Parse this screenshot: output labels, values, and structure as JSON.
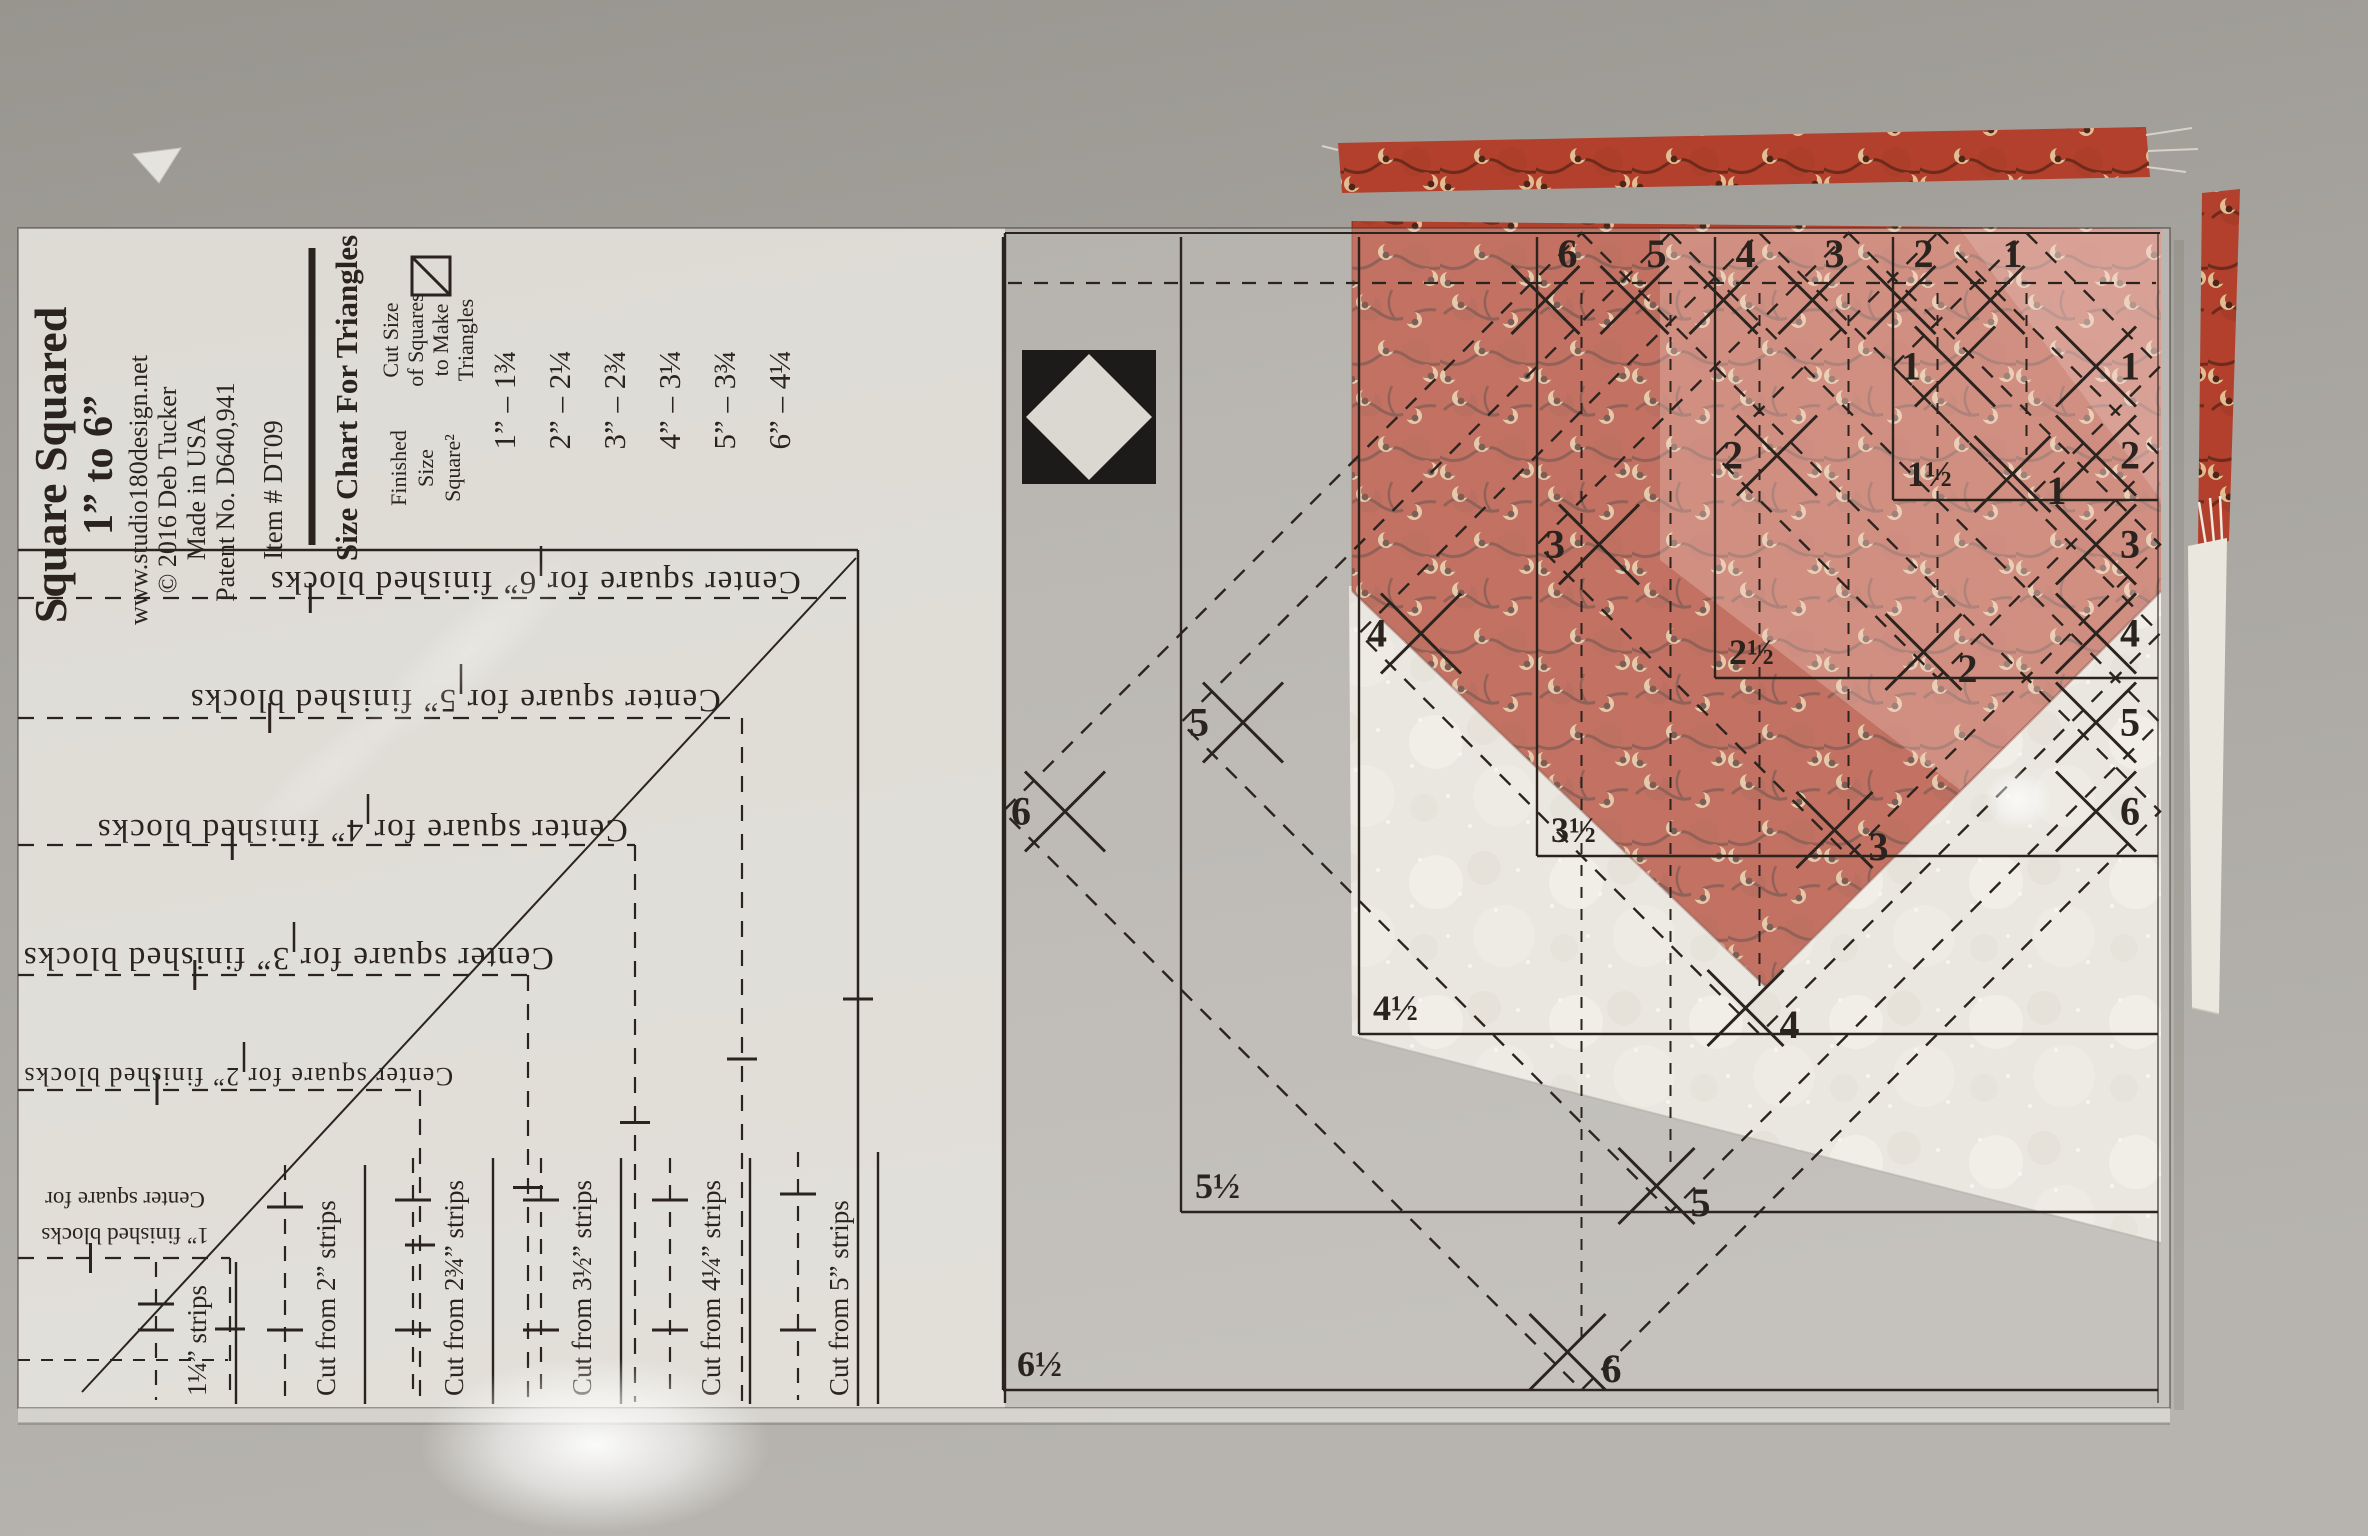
{
  "ruler": {
    "brand": {
      "title": "Square Squared",
      "subtitle": "1” to 6”",
      "website": "www.studio180design.net",
      "copyright": "© 2016 Deb Tucker",
      "origin": "Made in USA",
      "patent": "Patent No. D640,941",
      "item": "Item # DT09"
    },
    "size_chart": {
      "heading": "Size Chart For Triangles",
      "finished_header_lines": [
        "Finished",
        "Size",
        "Square²"
      ],
      "cut_header_lines": [
        "Cut Size",
        "of Squares",
        "to Make",
        "Triangles"
      ],
      "rows": [
        {
          "finished": "1”",
          "cut": "1¾"
        },
        {
          "finished": "2”",
          "cut": "2¼"
        },
        {
          "finished": "3”",
          "cut": "2¾"
        },
        {
          "finished": "4”",
          "cut": "3¼"
        },
        {
          "finished": "5”",
          "cut": "3¾"
        },
        {
          "finished": "6”",
          "cut": "4¼"
        }
      ]
    },
    "center_square_labels": {
      "prefix": "Center square for",
      "suffix": "finished blocks",
      "sizes": [
        "6”",
        "5”",
        "4”",
        "3”",
        "2”",
        "1”"
      ]
    },
    "strip_labels": [
      "1¼” strips",
      "Cut from 2” strips",
      "Cut from 2¾” strips",
      "Cut from 3½” strips",
      "Cut from 4¼” strips",
      "Cut from 5” strips"
    ],
    "grid": {
      "corner_labels": [
        "1½",
        "2½",
        "3½",
        "4½",
        "5½",
        "6½"
      ],
      "top_numbers": [
        "6",
        "5",
        "4",
        "3",
        "2",
        "1"
      ],
      "right_numbers": [
        "1",
        "2",
        "3",
        "4",
        "5",
        "6"
      ],
      "diagonal_numbers": [
        "6",
        "5",
        "4",
        "3",
        "2",
        "1"
      ],
      "bottom_numbers": [
        "1",
        "2",
        "3",
        "4",
        "5",
        "6"
      ]
    }
  },
  "icons": {
    "logo": "diamond-in-square-logo-icon",
    "chart_icon": "half-square-triangle-icon",
    "marks": "x-registration-mark-icon"
  },
  "colors": {
    "surface_top": "#9c9993",
    "surface_bottom": "#b6b3ae",
    "print": "#2b231e",
    "red_fabric": "#b2402c",
    "red_vine": "#6e2a1d",
    "red_crescent": "#e3bd92",
    "white_fabric": "#ebe8e0",
    "logo_black": "#1c1b19"
  }
}
